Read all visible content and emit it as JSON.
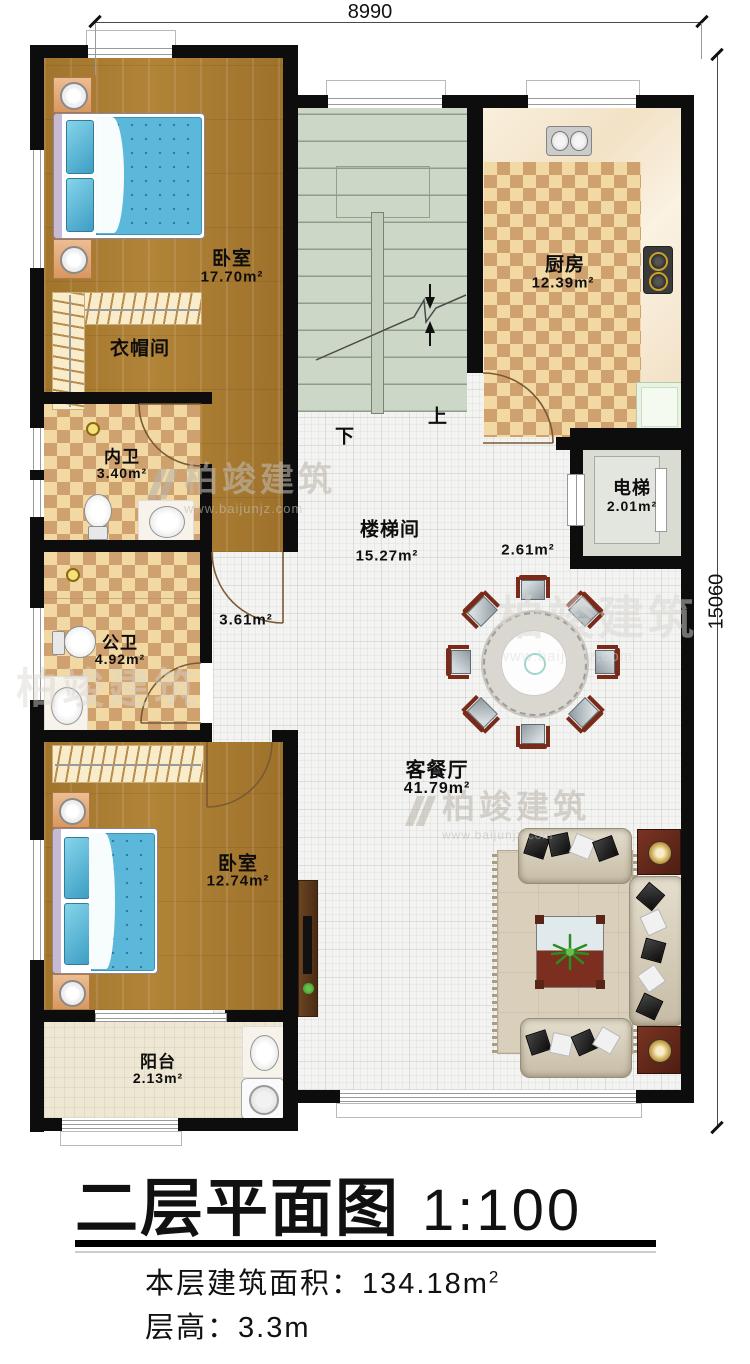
{
  "dimensions": {
    "width_label": "8990",
    "height_label": "15060"
  },
  "title": {
    "name": "二层平面图",
    "scale": "1:100",
    "area_label": "本层建筑面积：",
    "area_value": "134.18m",
    "area_sup": "2",
    "height_label": "层高：",
    "height_value": "3.3m"
  },
  "rooms": {
    "bedroom1": {
      "name": "卧室",
      "area": "17.70m²"
    },
    "cloakroom": {
      "name": "衣帽间"
    },
    "inner_bath": {
      "name": "内卫",
      "area": "3.40m²"
    },
    "public_bath": {
      "name": "公卫",
      "area": "4.92m²"
    },
    "bedroom2": {
      "name": "卧室",
      "area": "12.74m²"
    },
    "balcony": {
      "name": "阳台",
      "area": "2.13m²"
    },
    "kitchen": {
      "name": "厨房",
      "area": "12.39m²"
    },
    "stairwell": {
      "name": "楼梯间",
      "area": "15.27m²"
    },
    "elevator": {
      "name": "电梯",
      "area": "2.01m²"
    },
    "living_dining": {
      "name": "客餐厅",
      "area": "41.79m²"
    },
    "hall_by_elevator": {
      "area": "2.61m²"
    },
    "hall_corridor": {
      "area": "3.61m²"
    }
  },
  "stairs": {
    "down_label": "下",
    "up_label": "上"
  },
  "watermark": {
    "brand": "柏竣建筑",
    "url": "www.baijunjz.com"
  },
  "colors": {
    "wall": "#0d0d0d",
    "wood_floor": "#a87b35",
    "checker_light": "#f2d9a4",
    "checker_dark": "#cfa16f",
    "stair_floor": "#cdd7c8",
    "tile_floor": "#f3f3f1",
    "balcony_floor": "#eee7d3",
    "bed_blue": "#5cb8da"
  }
}
